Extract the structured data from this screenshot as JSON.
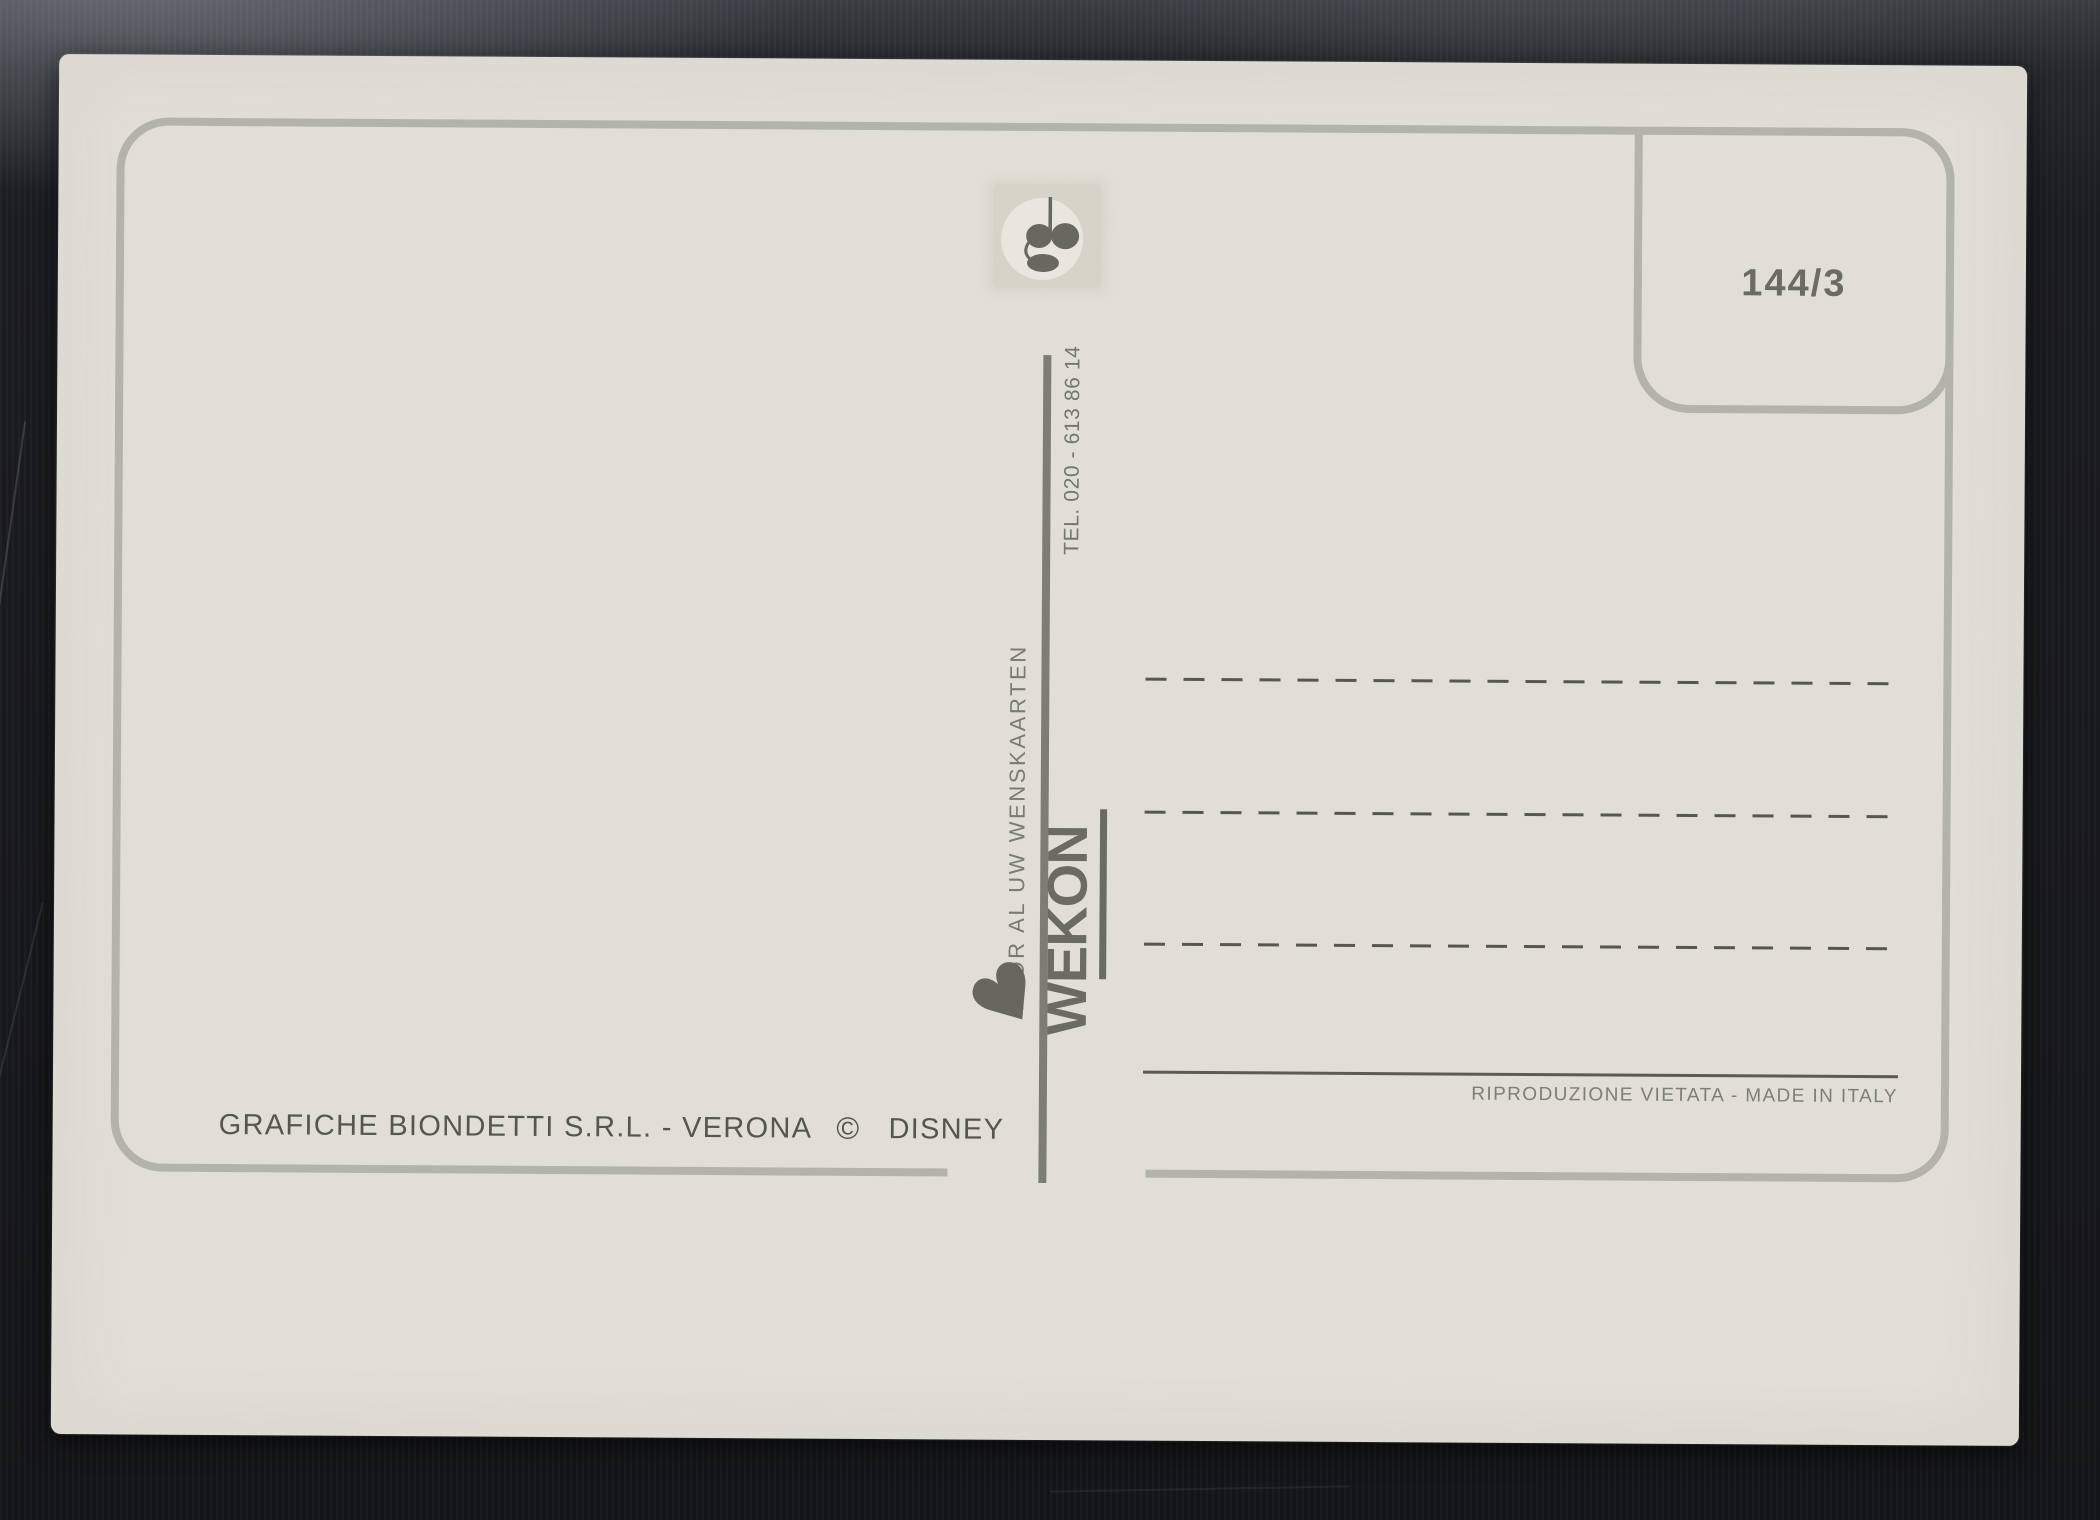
{
  "postcard": {
    "stamp_box": {
      "number": "144/3"
    },
    "divider": {
      "phone": "TEL. 020 - 613 86 14",
      "tagline": "VOOR AL UW WENSKAARTEN",
      "logo_text": "WEKON"
    },
    "address_area": {
      "dashed_line_count": 3
    },
    "footer": {
      "printer": "GRAFICHE BIONDETTI S.R.L. - VERONA",
      "copyright_symbol": "©",
      "brand": "DISNEY",
      "rights": "RIPRODUZIONE VIETATA - MADE IN ITALY"
    }
  },
  "icons": {
    "heart_glyph": "♥",
    "publisher_mark": "gb-monogram-icon"
  },
  "colors": {
    "background": "#1b1c20",
    "card": "#e1ded7",
    "border": "#b3b2ab",
    "divider": "#7d7c75",
    "ink_dark": "#56554e",
    "ink_medium": "#6b6a63",
    "ink_light": "#7e7d76",
    "dash": "#57564f"
  }
}
